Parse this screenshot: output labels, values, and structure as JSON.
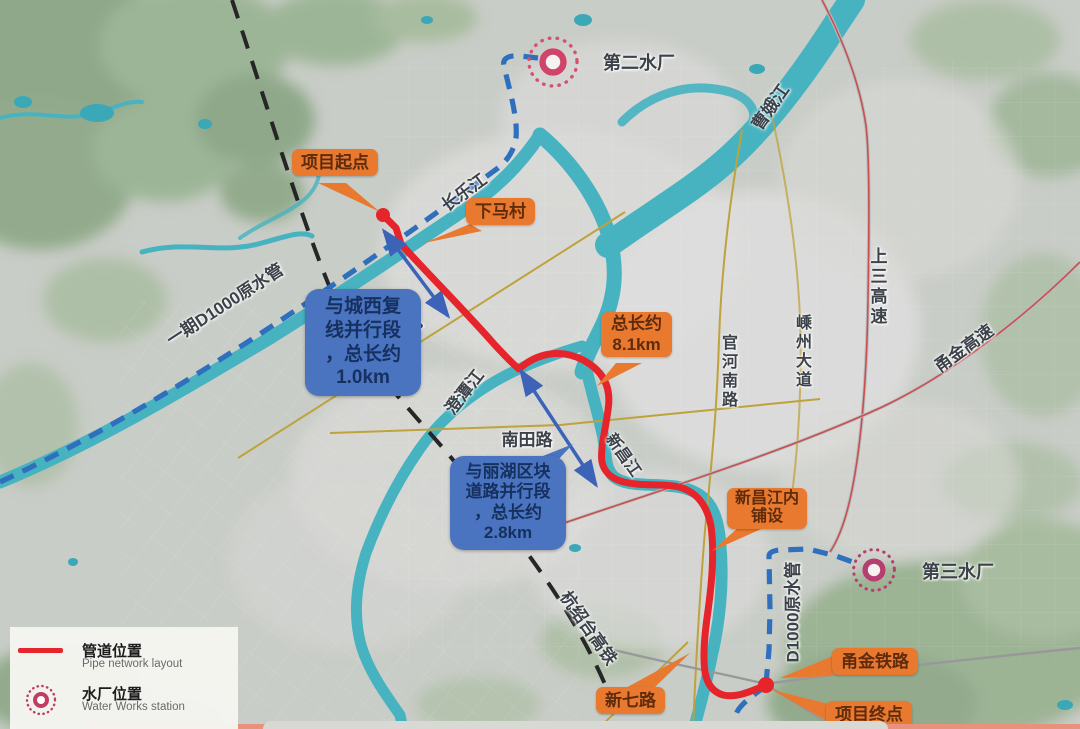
{
  "callouts": {
    "project_start": "项目起点",
    "xiama_village": "下马村",
    "total_length": "总长约\n8.1km",
    "xinchang_laid": "新昌江内\n铺设",
    "yongjin_railway": "甬金铁路",
    "project_end": "项目终点",
    "xinqi_road": "新七路",
    "parallel_west": "与城西复\n线并行段\n，总长约\n1.0km",
    "parallel_lihu": "与丽湖区块\n道路并行段\n，总长约\n2.8km"
  },
  "map_labels": {
    "changlejiang": "长乐江",
    "caoejiang": "曹娥江",
    "phase1_pipe": "一期D1000原水管",
    "shengyi_line": "嵊义线",
    "chengtanjiang": "澄潭江",
    "nantian_road": "南田路",
    "xinchangjiang": "新昌江",
    "guanhe_south_road": "官河南路",
    "shengzhou_avenue": "嵊州大道",
    "shangsan_expressway": "上三高速",
    "yongjin_expressway": "甬金高速",
    "hangshaotai_hsr": "杭绍台高铁",
    "d1000_pipe": "D1000原水管",
    "water_plant_2": "第二水厂",
    "water_plant_3": "第三水厂"
  },
  "legend": {
    "pipe_label_zh": "管道位置",
    "pipe_label_en": "Pipe network layout",
    "waterworks_label_zh": "水厂位置",
    "waterworks_label_en": "Water Works station"
  },
  "icons": {
    "waterworks_icon": "concentric-dotted-circle",
    "pipe_swatch": "red-line"
  },
  "colors": {
    "orange_label": "#E8792F",
    "blue_label": "#4A74C0",
    "pipe_red": "#E5252B",
    "raw_pipe_blue": "#2F6FBD",
    "waterworks_pink": "#CD4568",
    "railway_black": "#262626",
    "river_teal": "#47B3C1",
    "road_gold": "#BFA23B"
  }
}
